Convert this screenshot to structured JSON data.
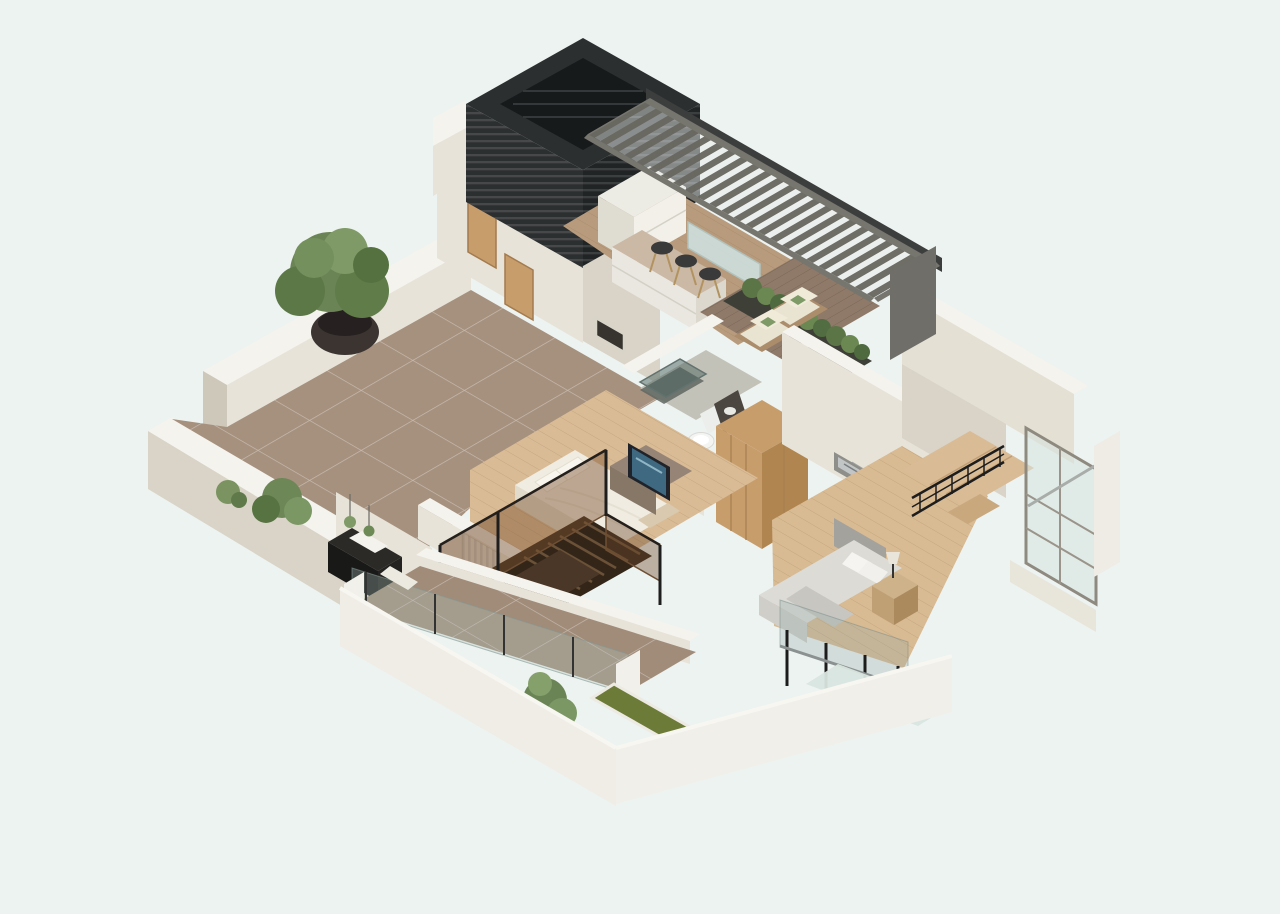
{
  "meta": {
    "title": "3D isometric floor plan render",
    "view": "axonometric cut-away of an apartment upper floor",
    "rooms": [
      {
        "name": "terrace",
        "items": [
          "potted-tree",
          "shrubs",
          "black-console",
          "hanging-plants",
          "tile-floor"
        ]
      },
      {
        "name": "entry-hall",
        "items": [
          "oak-doors",
          "small-window"
        ]
      },
      {
        "name": "louver-tower",
        "items": [
          "black-slatted-enclosure"
        ]
      },
      {
        "name": "kitchen-dining",
        "items": [
          "white-cabinets",
          "island-bar",
          "three-bar-stools",
          "glass-partition",
          "slatted-pergola"
        ]
      },
      {
        "name": "lounge-deck",
        "items": [
          "two-wood-armchairs",
          "green-cushions",
          "hedge-planter",
          "dark-wood-deck"
        ]
      },
      {
        "name": "bathroom",
        "items": [
          "glass-shower",
          "toilet",
          "dark-vanity"
        ]
      },
      {
        "name": "wardrobe-hall",
        "items": [
          "oak-wardrobes"
        ]
      },
      {
        "name": "bedroom-master",
        "items": [
          "white-bed",
          "tv-console",
          "tv",
          "radiator",
          "amber-glass-stair-rail",
          "dark-wood-stairs"
        ]
      },
      {
        "name": "bedroom-second",
        "items": [
          "gray-bed",
          "wall-art",
          "nightstand-with-lamp",
          "glass-balustrade"
        ]
      },
      {
        "name": "stair-hall",
        "items": [
          "blank-wall",
          "black-railing",
          "wood-landing",
          "corner-window"
        ]
      },
      {
        "name": "balcony",
        "items": [
          "tile-floor",
          "glass-railing",
          "white-posts",
          "grass-planter-strip",
          "potted-plant"
        ]
      }
    ]
  },
  "palette": {
    "background": "#edf3f1",
    "wall_top": "#f5f3ed",
    "wall_light": "#e7e3d8",
    "wall_mid": "#d9d4c7",
    "wall_shadow": "#cdc8ba",
    "outer_wall": "#efede6",
    "outer_wall2": "#f1efe9",
    "terrace_tile": "#a6917e",
    "balcony_tile": "#a18c79",
    "kitchen_floor": "#b79b7c",
    "wood_floor": "#d9bb96",
    "wood_floor2": "#d8ba93",
    "deck": "#8f7a69",
    "tower_dark": "#2c2f30",
    "tower_inner": "#171a1b",
    "pergola_frame": "#76756e",
    "pergola_beam": "#3c3e3e",
    "pergola_endwall": "#6f6e69",
    "oak": "#c89d6c",
    "oak_dark": "#b0854f",
    "glass_blue": "#cfe3e4",
    "hedge": "#5c7546",
    "plant_green": "#6b8455",
    "planter_grass": "#6d7b38",
    "stairs_wood": "#4b3728",
    "rail_black": "#1d1d1d",
    "bed_white": "#f0ece1",
    "bed_gray": "#dcdbd6",
    "sofa_cushion": "#e9e3d1",
    "pillow_green": "#7d9a67",
    "tv_screen": "#3f6981",
    "art_gray": "#c2c5c6",
    "island_top": "#cbb8a5",
    "radiator": "#eceae3"
  }
}
